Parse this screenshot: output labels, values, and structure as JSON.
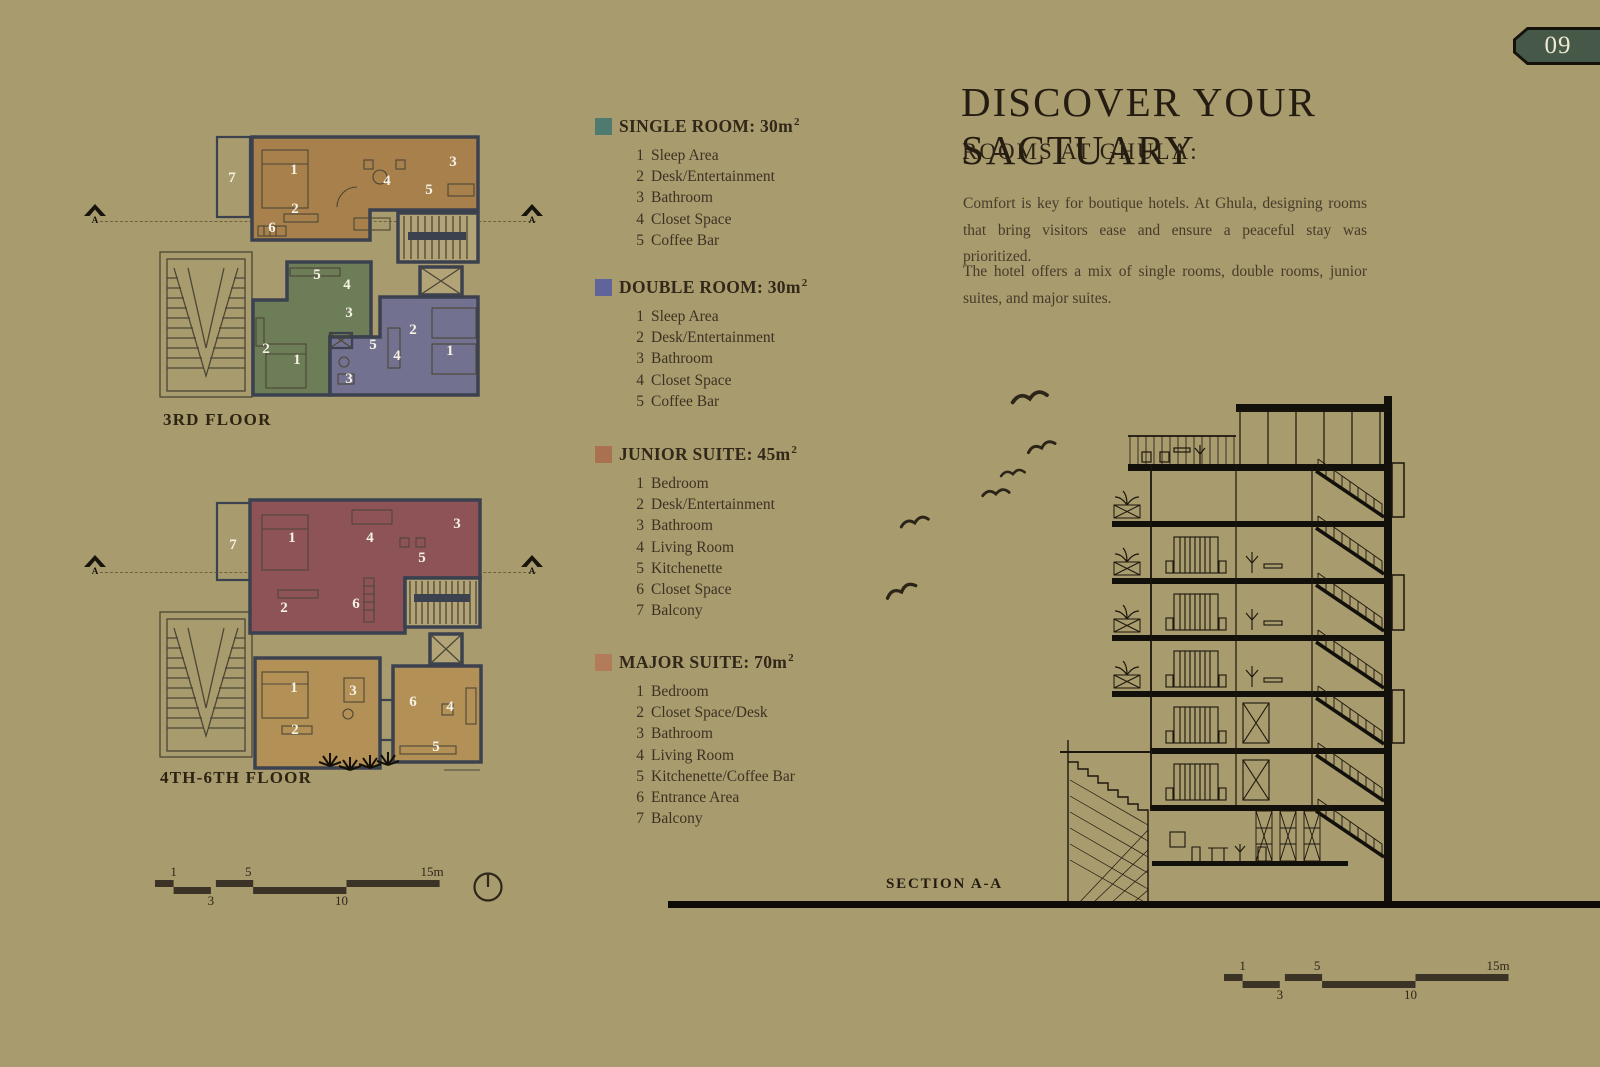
{
  "page": {
    "number": "09"
  },
  "colors": {
    "page_bg": "#a89b6d",
    "floor3_suite": "#a8804c",
    "floor3_balcony": "#b18a55",
    "single": "#6d7d57",
    "double": "#72718f",
    "junior": "#8e5356",
    "junior_balcony": "#985d60",
    "major": "#b39156",
    "core": "#b2a476"
  },
  "header": {
    "title": "DISCOVER YOUR SACTUARY",
    "subtitle": "ROOMS AT GHULA:"
  },
  "intro": {
    "para1": "Comfort is key for boutique hotels. At Ghula, designing rooms that bring visitors ease and ensure a peaceful stay was prioritized.",
    "para2": "The hotel offers a mix of single rooms, double rooms, junior suites, and major suites."
  },
  "legend": {
    "rooms": [
      {
        "name": "SINGLE ROOM: 30m",
        "sup": "2",
        "color": "#4e7a6f",
        "items": [
          {
            "n": "1",
            "t": "Sleep Area"
          },
          {
            "n": "2",
            "t": "Desk/Entertainment"
          },
          {
            "n": "3",
            "t": "Bathroom"
          },
          {
            "n": "4",
            "t": "Closet Space"
          },
          {
            "n": "5",
            "t": "Coffee Bar"
          }
        ]
      },
      {
        "name": "DOUBLE ROOM: 30m",
        "sup": "2",
        "color": "#5f659a",
        "items": [
          {
            "n": "1",
            "t": "Sleep Area"
          },
          {
            "n": "2",
            "t": "Desk/Entertainment"
          },
          {
            "n": "3",
            "t": "Bathroom"
          },
          {
            "n": "4",
            "t": "Closet Space"
          },
          {
            "n": "5",
            "t": "Coffee Bar"
          }
        ]
      },
      {
        "name": "JUNIOR SUITE: 45m",
        "sup": "2",
        "color": "#aa7150",
        "items": [
          {
            "n": "1",
            "t": "Bedroom"
          },
          {
            "n": "2",
            "t": "Desk/Entertainment"
          },
          {
            "n": "3",
            "t": "Bathroom"
          },
          {
            "n": "4",
            "t": "Living Room"
          },
          {
            "n": "5",
            "t": "Kitchenette"
          },
          {
            "n": "6",
            "t": "Closet Space"
          },
          {
            "n": "7",
            "t": "Balcony"
          }
        ]
      },
      {
        "name": "MAJOR SUITE: 70m",
        "sup": "2",
        "color": "#b27c5a",
        "items": [
          {
            "n": "1",
            "t": "Bedroom"
          },
          {
            "n": "2",
            "t": "Closet Space/Desk"
          },
          {
            "n": "3",
            "t": "Bathroom"
          },
          {
            "n": "4",
            "t": "Living Room"
          },
          {
            "n": "5",
            "t": "Kitchenette/Coffee Bar"
          },
          {
            "n": "6",
            "t": "Entrance Area"
          },
          {
            "n": "7",
            "t": "Balcony"
          }
        ]
      }
    ]
  },
  "plans": {
    "floor3": {
      "label": "3RD FLOOR",
      "marker": "A",
      "major": [
        "7",
        "1",
        "2",
        "6",
        "4",
        "5",
        "3"
      ],
      "single": [
        "5",
        "4",
        "3",
        "2",
        "1"
      ],
      "double": [
        "2",
        "5",
        "4",
        "1",
        "3"
      ]
    },
    "floor46": {
      "label": "4TH-6TH FLOOR",
      "marker": "A",
      "junior": [
        "7",
        "1",
        "4",
        "3",
        "5",
        "2",
        "6"
      ],
      "major": [
        "1",
        "3",
        "2",
        "6",
        "4",
        "5"
      ]
    }
  },
  "section": {
    "label": "SECTION A-A"
  },
  "scalebar": {
    "top": [
      "1",
      "5",
      "15m"
    ],
    "bottom": [
      "3",
      "10"
    ]
  }
}
